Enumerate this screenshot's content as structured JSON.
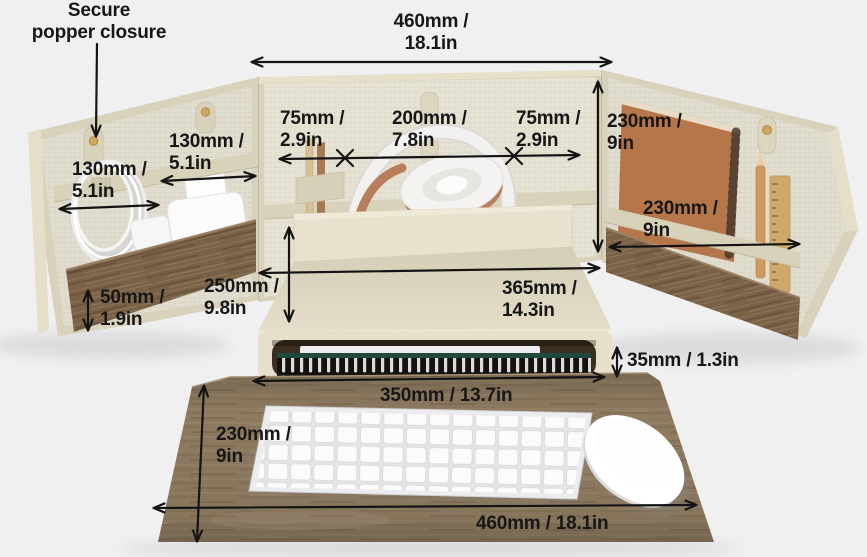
{
  "callout": {
    "text": "Secure\npopper closure"
  },
  "dimensions": {
    "organizer_width": {
      "label": "460mm /\n18.1in",
      "mm": 460,
      "in": 18.1
    },
    "left_strap_left": {
      "label": "130mm /\n5.1in",
      "mm": 130,
      "in": 5.1
    },
    "left_strap_right": {
      "label": "130mm /\n5.1in",
      "mm": 130,
      "in": 5.1
    },
    "shelf_left": {
      "label": "75mm /\n2.9in",
      "mm": 75,
      "in": 2.9
    },
    "shelf_center": {
      "label": "200mm /\n7.8in",
      "mm": 200,
      "in": 7.8
    },
    "shelf_right": {
      "label": "75mm /\n2.9in",
      "mm": 75,
      "in": 2.9
    },
    "right_panel_height": {
      "label": "230mm /\n9in",
      "mm": 230,
      "in": 9
    },
    "right_panel_width": {
      "label": "230mm /\n9in",
      "mm": 230,
      "in": 9
    },
    "left_pocket_height": {
      "label": "50mm /\n1.9in",
      "mm": 50,
      "in": 1.9
    },
    "stand_depth": {
      "label": "250mm /\n9.8in",
      "mm": 250,
      "in": 9.8
    },
    "stand_width": {
      "label": "365mm /\n14.3in",
      "mm": 365,
      "in": 14.3
    },
    "slot_height": {
      "label": "35mm / 1.3in",
      "mm": 35,
      "in": 1.3
    },
    "slot_width": {
      "label": "350mm / 13.7in",
      "mm": 350,
      "in": 13.7
    },
    "mat_depth": {
      "label": "230mm /\n9in",
      "mm": 230,
      "in": 9
    },
    "mat_width": {
      "label": "460mm / 18.1in",
      "mm": 460,
      "in": 18.1
    }
  },
  "scene_items": [
    "tri-fold-organizer",
    "left-panel",
    "back-panel",
    "right-panel",
    "popper-straps",
    "cable-coil",
    "power-adapter",
    "wall-plug",
    "pencil-cup",
    "headphones",
    "spiral-notebook",
    "pencil",
    "wooden-ruler",
    "monitor-stand",
    "notebooks-under-stand",
    "wooden-desk-mat",
    "wireless-keyboard",
    "wireless-mouse"
  ],
  "colors": {
    "background": "#f0f0f1",
    "linen": "#e5e1d2",
    "leather_trim": "#d8d1bb",
    "wood_pocket": "#7a6248",
    "wood_mat": "#8d7a60",
    "notebook_kraft": "#b5764a",
    "copper_accent": "#b97e5c",
    "popper_gold": "#cfa75f",
    "annotation_text": "#171717"
  }
}
